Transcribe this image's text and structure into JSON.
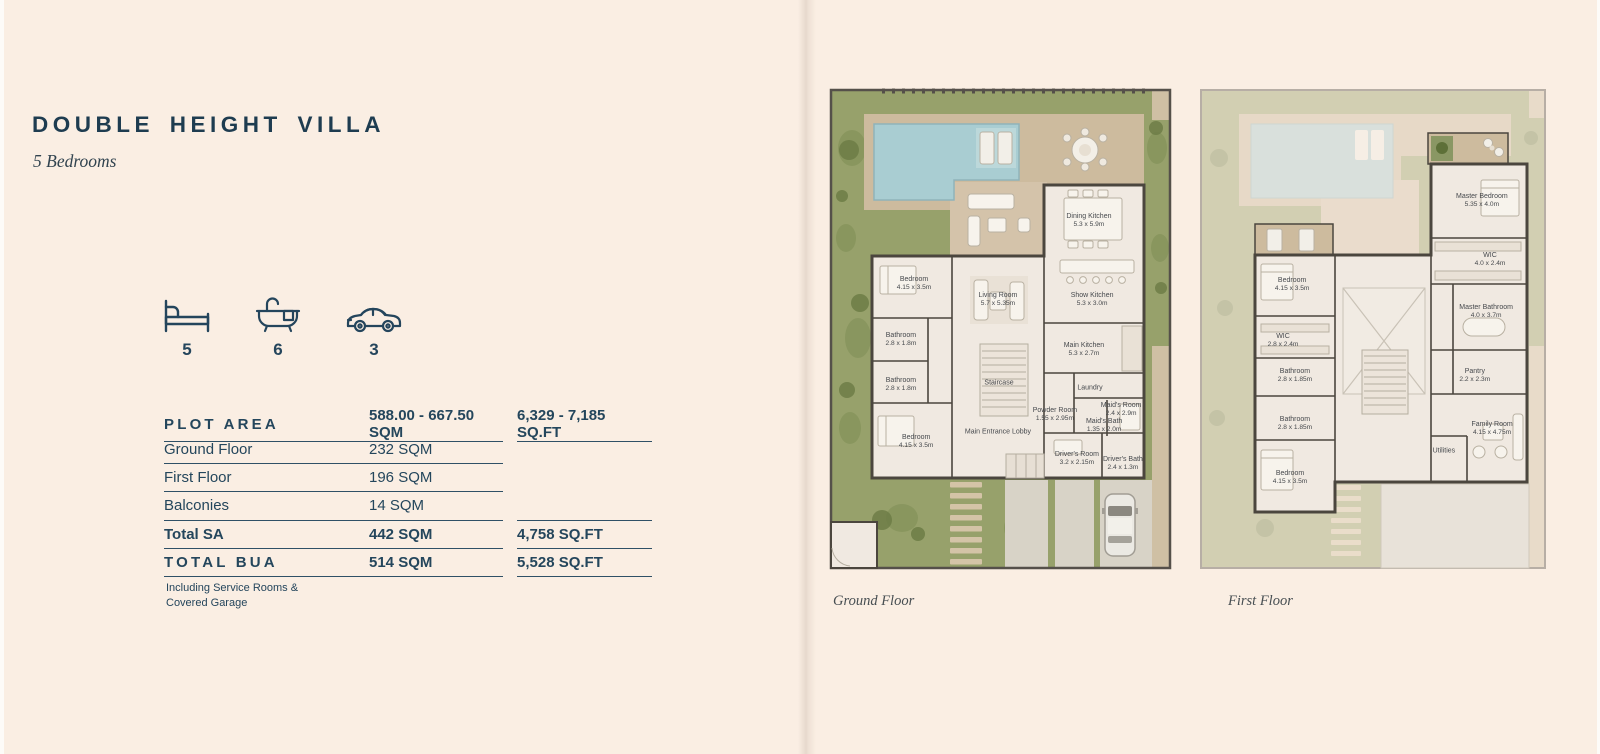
{
  "page": {
    "title": "DOUBLE HEIGHT VILLA",
    "subtitle": "5 Bedrooms",
    "background": "#faeee3",
    "accent": "#24455c"
  },
  "stats": [
    {
      "icon": "bed-icon",
      "value": "5"
    },
    {
      "icon": "bathtub-icon",
      "value": "6"
    },
    {
      "icon": "car-icon",
      "value": "3"
    }
  ],
  "area_table": {
    "rows": [
      {
        "label": "PLOT AREA",
        "sqm": "588.00 - 667.50 SQM",
        "sqft": "6,329 - 7,185 SQ.FT"
      },
      {
        "label": "Ground Floor",
        "sqm": "232 SQM",
        "sqft": ""
      },
      {
        "label": "First Floor",
        "sqm": "196 SQM",
        "sqft": ""
      },
      {
        "label": "Balconies",
        "sqm": "14 SQM",
        "sqft": ""
      },
      {
        "label": "Total SA",
        "sqm": "442 SQM",
        "sqft": "4,758 SQ.FT"
      },
      {
        "label": "TOTAL BUA",
        "sqm": "514 SQM",
        "sqft": "5,528 SQ.FT"
      }
    ],
    "footnote": [
      "Including Service Rooms &",
      "Covered Garage"
    ]
  },
  "plans": {
    "ground": {
      "caption": "Ground Floor",
      "rooms": [
        {
          "name": "Dining Kitchen",
          "dims": "5.3 x 5.9m",
          "x": 75.4,
          "y": 27.6
        },
        {
          "name": "Bedroom",
          "dims": "4.15 x 3.5m",
          "x": 26.0,
          "y": 40.7
        },
        {
          "name": "Living Room",
          "dims": "5.7 x 5.35m",
          "x": 49.7,
          "y": 44.0
        },
        {
          "name": "Show Kitchen",
          "dims": "5.3 x 3.0m",
          "x": 76.3,
          "y": 44.0
        },
        {
          "name": "Bathroom",
          "dims": "2.8 x 1.8m",
          "x": 22.3,
          "y": 52.3
        },
        {
          "name": "Main Kitchen",
          "dims": "5.3 x 2.7m",
          "x": 74.0,
          "y": 54.4
        },
        {
          "name": "Bathroom",
          "dims": "2.8 x 1.8m",
          "x": 22.3,
          "y": 61.6
        },
        {
          "name": "Staircase",
          "dims": "",
          "x": 50.0,
          "y": 61.2
        },
        {
          "name": "Laundry",
          "dims": "",
          "x": 75.7,
          "y": 62.2
        },
        {
          "name": "Powder Room",
          "dims": "1.55 x 2.95m",
          "x": 65.8,
          "y": 67.8
        },
        {
          "name": "Maid's Room",
          "dims": "2.4 x 2.9m",
          "x": 84.5,
          "y": 66.8
        },
        {
          "name": "Maid's Bath",
          "dims": "1.35 x 2.0m",
          "x": 79.7,
          "y": 70.1
        },
        {
          "name": "Main Entrance Lobby",
          "dims": "",
          "x": 49.7,
          "y": 71.4
        },
        {
          "name": "Bedroom",
          "dims": "4.15 x 3.5m",
          "x": 26.6,
          "y": 73.4
        },
        {
          "name": "Driver's Room",
          "dims": "3.2 x 2.15m",
          "x": 72.0,
          "y": 77.0
        },
        {
          "name": "Driver's Bath",
          "dims": "2.4 x 1.3m",
          "x": 85.0,
          "y": 78.0
        }
      ]
    },
    "first": {
      "caption": "First Floor",
      "rooms": [
        {
          "name": "Master Bedroom",
          "dims": "5.35 x 4.0m",
          "x": 81.5,
          "y": 23.4
        },
        {
          "name": "WIC",
          "dims": "4.0 x 2.4m",
          "x": 83.8,
          "y": 35.7
        },
        {
          "name": "Bedroom",
          "dims": "4.15 x 3.5m",
          "x": 27.6,
          "y": 40.9
        },
        {
          "name": "Master Bathroom",
          "dims": "4.0 x 3.7m",
          "x": 82.7,
          "y": 46.5
        },
        {
          "name": "WIC",
          "dims": "2.8 x 2.4m",
          "x": 25.0,
          "y": 52.5
        },
        {
          "name": "Bathroom",
          "dims": "2.8 x 1.85m",
          "x": 28.4,
          "y": 59.8
        },
        {
          "name": "Pantry",
          "dims": "2.2 x 2.3m",
          "x": 79.5,
          "y": 59.8
        },
        {
          "name": "Bathroom",
          "dims": "2.8 x 1.85m",
          "x": 28.4,
          "y": 69.7
        },
        {
          "name": "Family Room",
          "dims": "4.15 x 4.75m",
          "x": 84.4,
          "y": 70.7
        },
        {
          "name": "Utilities",
          "dims": "",
          "x": 70.7,
          "y": 75.3
        },
        {
          "name": "Bedroom",
          "dims": "4.15 x 3.5m",
          "x": 27.0,
          "y": 80.9
        }
      ]
    }
  }
}
